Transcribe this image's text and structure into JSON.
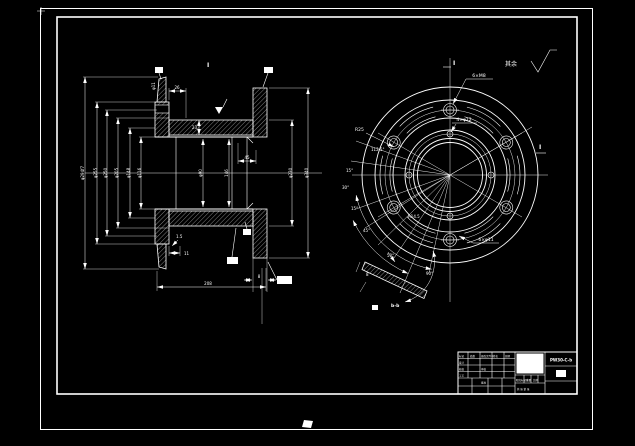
{
  "sheet": {
    "surface_note": "其余",
    "view_label": "I",
    "section_top": "I",
    "section_right": "I"
  },
  "left_view": {
    "dims_left": [
      "φ294f7",
      "φ255",
      "φ250",
      "φ205",
      "φ148",
      "φ116"
    ],
    "dims_right": [
      "φ230",
      "φ340"
    ],
    "dim_bore": "φ90",
    "dim_146": "146",
    "dim_45": "45",
    "dim_23": "23",
    "dim_26": "26",
    "dim_top_hole": "φ11",
    "dim_11": "11",
    "dim_chamfer": "1.5",
    "dim_208": "208",
    "dim_8": "8"
  },
  "right_view": {
    "bolt_note": "6×M8",
    "hole_note": "4×φ12",
    "radius_note": "R25",
    "angle_a": "112.5°",
    "angle_b": "15°",
    "angle_c": "30°",
    "angle_d": "15°",
    "angle_e": "45°",
    "rim_radius": "R14.5",
    "rim_holes": "6×φ11"
  },
  "detail_view": {
    "name": "b-b",
    "angle_sweep": "90°",
    "angle_pos": "50°",
    "thickness": "8"
  },
  "title_block": {
    "drawing_number": "PW30-C-b",
    "left_cells": [
      "标记",
      "处数",
      "更改文件号",
      "签名",
      "日期",
      "设计",
      "校核",
      "工艺",
      "审核",
      "批准"
    ],
    "mid_cells": [
      "阶段标记",
      "重量",
      "比例"
    ],
    "sheet_note": "共 张 第 张"
  }
}
